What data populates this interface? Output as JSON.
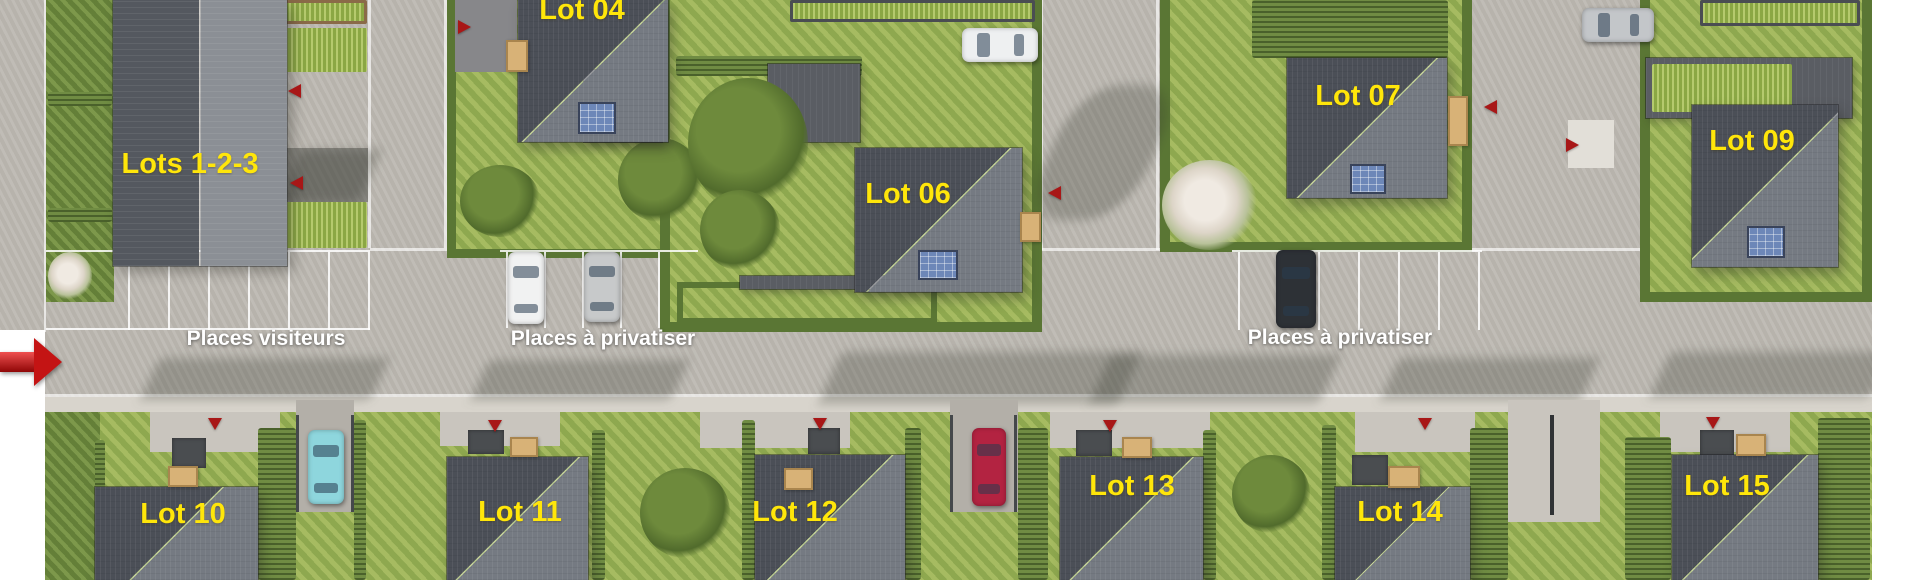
{
  "site": {
    "lots": [
      {
        "id": "lots-1-2-3",
        "label": "Lots 1-2-3"
      },
      {
        "id": "lot-04",
        "label": "Lot 04"
      },
      {
        "id": "lot-06",
        "label": "Lot 06"
      },
      {
        "id": "lot-07",
        "label": "Lot 07"
      },
      {
        "id": "lot-09",
        "label": "Lot 09"
      },
      {
        "id": "lot-10",
        "label": "Lot 10"
      },
      {
        "id": "lot-11",
        "label": "Lot 11"
      },
      {
        "id": "lot-12",
        "label": "Lot 12"
      },
      {
        "id": "lot-13",
        "label": "Lot 13"
      },
      {
        "id": "lot-14",
        "label": "Lot 14"
      },
      {
        "id": "lot-15",
        "label": "Lot 15"
      }
    ],
    "parking_labels": {
      "visitors": "Places visiteurs",
      "privatiser_west": "Places à privatiser",
      "privatiser_east": "Places à privatiser"
    },
    "icons": {
      "entrance_arrow": "large red right-arrow at site entrance",
      "lot_entrance_arrow": "small red triangle marking lot entrances"
    },
    "cars": [
      {
        "name": "white-car-top",
        "color": "#eef0f1"
      },
      {
        "name": "gray-car-top-right",
        "color": "#c3c6c9"
      },
      {
        "name": "white-car-visitor",
        "color": "#f1f2f2"
      },
      {
        "name": "silver-car-visitor",
        "color": "#c7c9ca"
      },
      {
        "name": "black-car",
        "color": "#2d3136"
      },
      {
        "name": "teal-car",
        "color": "#8ed6dd"
      },
      {
        "name": "red-car",
        "color": "#b32341"
      }
    ],
    "colors": {
      "lot-label": "#ffe60a",
      "parking-label": "#ffffff",
      "arrow-red": "#a81717",
      "entrance-red": "#c41414",
      "roof-dark": "#4b4f57",
      "roof-light": "#757a82",
      "building-dark": "#54585f",
      "building-light": "#8b8f95",
      "lawn": "#9ab257",
      "lawn-dark": "#718c41",
      "hedge": "#5a7634",
      "hedge-bright": "#9cb84f",
      "road": "#bdb9b2",
      "sidewalk": "#d8d4cc",
      "road-light": "#c9c5be",
      "drive": "#b3afa8",
      "solar": "#6d87b8",
      "wood": "#d8b277",
      "fence": "#45484b",
      "path-dark": "#4a4d50"
    }
  }
}
